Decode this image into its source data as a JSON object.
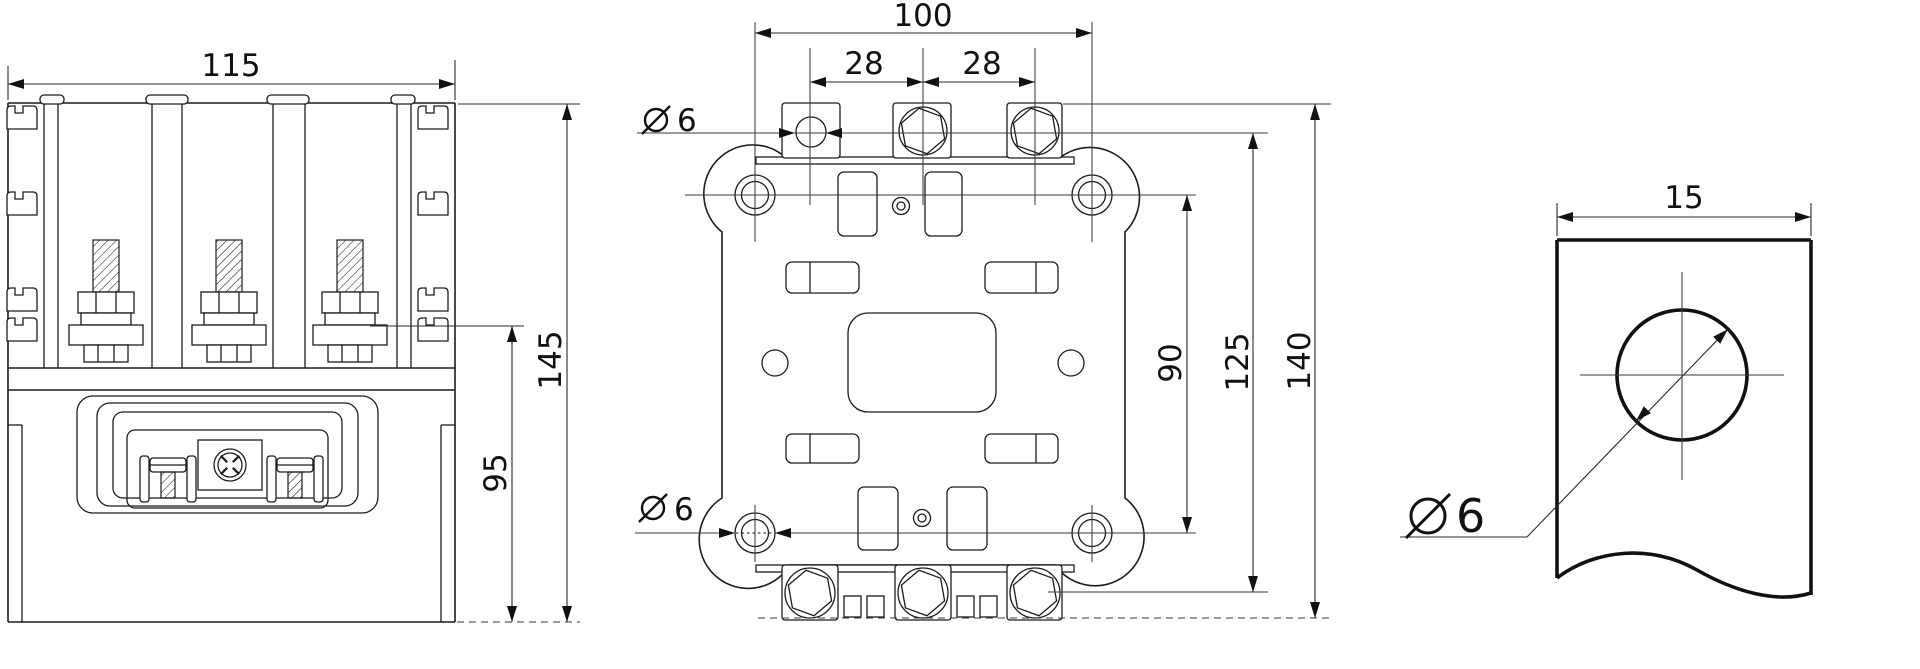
{
  "drawing": {
    "background_color": "#ffffff",
    "line_color": "#1c1c1c",
    "views": {
      "front": {
        "dims": {
          "width": "115",
          "overall_height": "145",
          "terminal_height": "95"
        }
      },
      "bottom": {
        "dims": {
          "mount_hole_spacing_h": "100",
          "pole_pitch_left": "28",
          "pole_pitch_right": "28",
          "top_hole_dia": {
            "symbol": "ø",
            "value": "6"
          },
          "bottom_hole_dia": {
            "symbol": "ø",
            "value": "6"
          },
          "mount_hole_spacing_v": "90",
          "terminal_row_spacing": "125",
          "overall_height": "140"
        }
      },
      "detail": {
        "dims": {
          "tab_width": "15",
          "hole_dia": {
            "symbol": "ø",
            "value": "6"
          }
        }
      }
    }
  }
}
